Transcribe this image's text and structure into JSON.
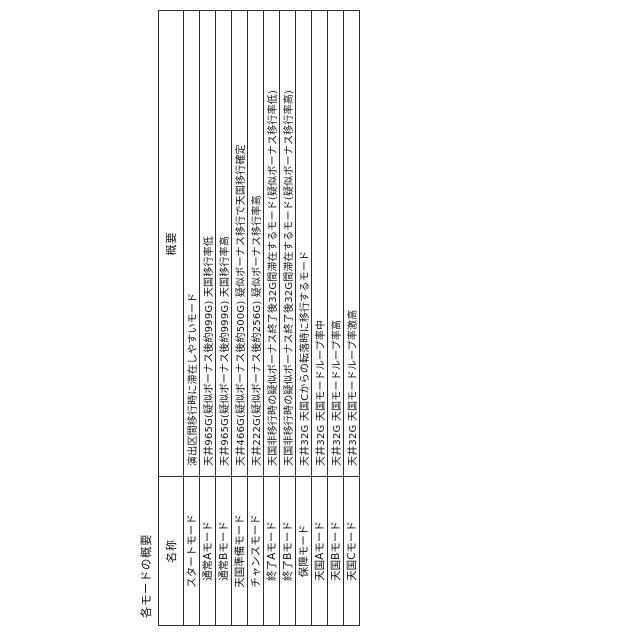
{
  "page": {
    "title": "各モードの概要"
  },
  "table": {
    "headers": {
      "name": "名称",
      "overview": "概要"
    },
    "rows": [
      {
        "name": "スタートモード",
        "overview": "演出区間移行時に滞在しやすいモード"
      },
      {
        "name": "通常Aモード",
        "overview": "天井965G(疑似ボーナス後約999G) 天国移行率低"
      },
      {
        "name": "通常Bモード",
        "overview": "天井965G(疑似ボーナス後約999G) 天国移行率高"
      },
      {
        "name": "天国準備モード",
        "overview": "天井466G(疑似ボーナス後約500G) 疑似ボーナス移行で天国移行確定"
      },
      {
        "name": "チャンスモード",
        "overview": "天井222G(疑似ボーナス後約256G) 疑似ボーナス移行率高"
      },
      {
        "name": "終了Aモード",
        "overview": "天国非移行時の疑似ボーナス終了後32G間滞在するモード(疑似ボーナス移行率低)"
      },
      {
        "name": "終了Bモード",
        "overview": "天国非移行時の疑似ボーナス終了後32G間滞在するモード(疑似ボーナス移行率高)"
      },
      {
        "name": "保障モード",
        "overview": "天井32G 天国Cからの転落時に移行するモード"
      },
      {
        "name": "天国Aモード",
        "overview": "天井32G 天国モードループ率中"
      },
      {
        "name": "天国Bモード",
        "overview": "天井32G 天国モードループ率高"
      },
      {
        "name": "天国Cモード",
        "overview": "天井32G 天国モードループ率激高"
      }
    ]
  },
  "orientation": {
    "rotation_degrees_ccw": 90,
    "reading_direction": "bottom-to-top"
  },
  "colors": {
    "background": "#ffffff",
    "border": "#2e2e2e",
    "text": "#111111"
  }
}
